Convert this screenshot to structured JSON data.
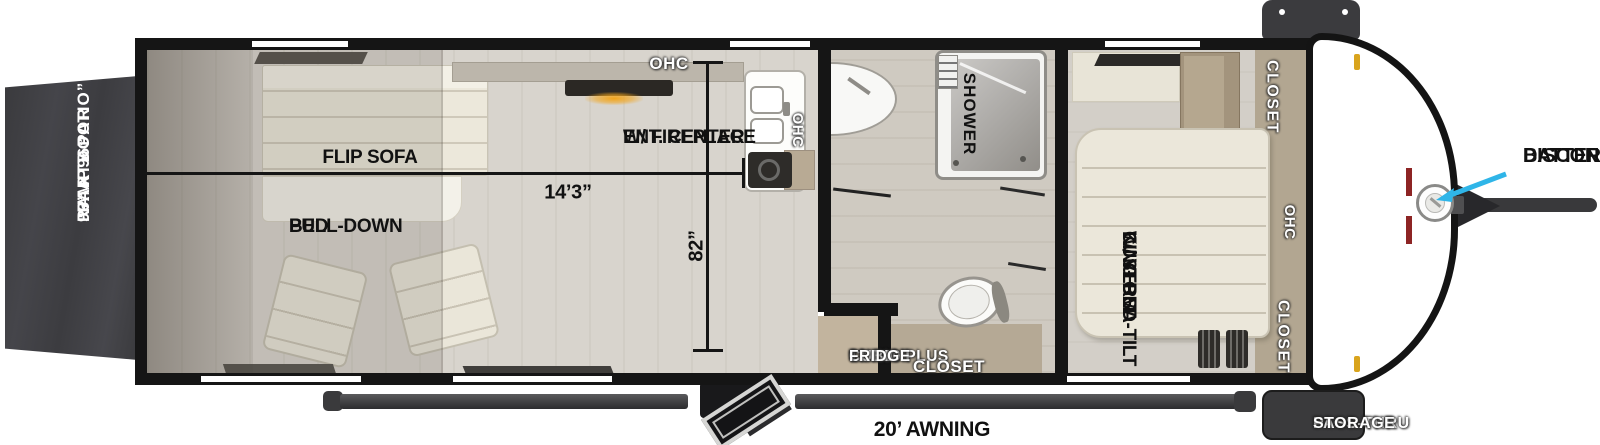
{
  "title": "Travel trailer floorplan",
  "colors": {
    "wall": "#151515",
    "floor": "#d8d4cd",
    "closet_tan": "#b2a691",
    "ramp_door": "#3f3f42",
    "fireplace_glow": "#f2a51c",
    "arrow_accent": "#2fb5e8",
    "marker_light": "#d9a41d",
    "badge_bg": "#3a3a3c"
  },
  "ramp_door": {
    "line1": "96” X 96”",
    "line2": "RAMP DOOR",
    "line3": "“PARTY PATIO”"
  },
  "garage": {
    "flip_sofa": "FLIP SOFA",
    "pull_down_line1": "PULL-DOWN",
    "pull_down_line2": "BED",
    "length_dim": "14’3”",
    "width_dim": "82”",
    "ohc_top": "OHC",
    "ent_line1": "ENT. CENTER",
    "ent_line2": "W/ FIREPLACE",
    "kitchen_ohc": "OHC"
  },
  "bathroom": {
    "shower": "SHOWER",
    "closet": "CLOSET",
    "fridge_line1": "12V 10’",
    "fridge_line2": "CUBIC PLUS",
    "fridge_line3": "FRIDGE"
  },
  "bedroom": {
    "bed_line1": "CUSTOM",
    "bed_line2": "KING BED",
    "bed_line3": "W/ VERSA-TILT",
    "closet_top": "CLOSET",
    "ohc": "OHC",
    "closet_bottom": "CLOSET"
  },
  "front": {
    "pass_thru_line1": "PASS-THRU",
    "pass_thru_line2": "STORAGE",
    "battery_line1": "BATTERY",
    "battery_line2": "DISCONNECT"
  },
  "exterior": {
    "awning": "20’ AWNING"
  }
}
